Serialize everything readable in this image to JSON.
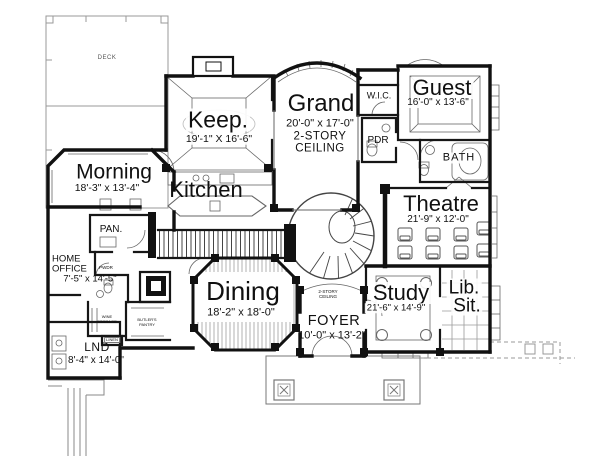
{
  "plan": {
    "title": "First floor plan",
    "colors": {
      "wall": "#111111",
      "thin_line": "#666666",
      "hatch": "#888888",
      "background": "#ffffff"
    },
    "rooms": {
      "morning": {
        "name": "Morning",
        "dims": "18'-3\" x 13'-4\""
      },
      "keep": {
        "name": "Keep.",
        "dims": "19'-1\" X 16'-6\""
      },
      "grand": {
        "name": "Grand",
        "dims": "20'-0\" x 17'-0\"",
        "note_line1": "2-STORY",
        "note_line2": "CEILING"
      },
      "guest": {
        "name": "Guest",
        "dims": "16'-0\" x 13'-6\""
      },
      "kitchen": {
        "name": "Kitchen"
      },
      "theatre": {
        "name": "Theatre",
        "dims": "21'-9\" x 12'-0\""
      },
      "dining": {
        "name": "Dining",
        "dims": "18'-2\" x 18'-0\""
      },
      "foyer": {
        "name": "FOYER",
        "dims": "10'-0\" x 13'-2\"",
        "note_line1": "2-STORY",
        "note_line2": "CEILING"
      },
      "study": {
        "name": "Study",
        "dims": "21'-6\" x 14'-9\""
      },
      "lib_sit": {
        "line1": "Lib.",
        "line2": "Sit."
      },
      "home_office": {
        "line1": "HOME",
        "line2": "OFFICE",
        "dims": "7'-5\" x 14'-5\""
      },
      "laundry": {
        "name": "LND",
        "dims": "8'-4\" x 14'-0\""
      },
      "wic": {
        "name": "W.I.C."
      },
      "powder": {
        "name": "PDR"
      },
      "bath": {
        "name": "BATH"
      },
      "pantry": {
        "name": "PAN."
      },
      "deck": {
        "name": "DECK"
      },
      "wine_storage": {
        "line1": "WINE",
        "line2": "STORAGE"
      },
      "butlers_pantry": {
        "line1": "BUTLER'S",
        "line2": "PANTRY"
      },
      "linen": {
        "name": "LINEN"
      },
      "pwdr_small": {
        "name": "PWDR"
      }
    }
  }
}
